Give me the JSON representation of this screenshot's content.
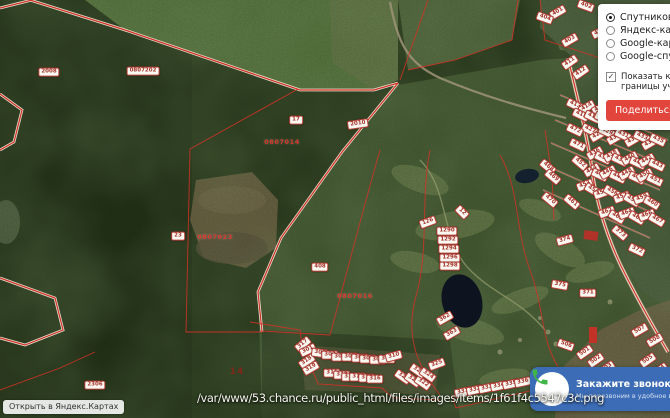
{
  "panel": {
    "options": [
      {
        "label": "Спутниковая карта",
        "selected": true
      },
      {
        "label": "Яндекс-карта",
        "selected": false
      },
      {
        "label": "Google-карта",
        "selected": false
      },
      {
        "label": "Google-спутник",
        "selected": false
      }
    ],
    "checkbox": {
      "label": "Показать кадастровые границы участков",
      "checked": true
    },
    "share_button": {
      "label": "Поделиться",
      "bg": "#e2453c",
      "color": "#ffffff"
    }
  },
  "call_widget": {
    "title": "Закажите звонок",
    "subtitle": "Мы перезвоним в удобное время",
    "bg": "#3c6cb5",
    "phone_icon_color": "#3fb549"
  },
  "yandex_button": {
    "label": "Открыть в Яндекс.Картах"
  },
  "overlay_path": "/var/www/53.chance.ru/public_html/files/images/items/1f61f4c5547c3c.png",
  "map": {
    "boundary_color": "#d23227",
    "labels": [
      {
        "x": 49,
        "y": 72,
        "r": 0,
        "t": "2008",
        "k": "box"
      },
      {
        "x": 143,
        "y": 71,
        "r": 0,
        "t": "0807202",
        "k": "box"
      },
      {
        "x": 296,
        "y": 120,
        "r": 0,
        "t": "17",
        "k": "box"
      },
      {
        "x": 358,
        "y": 124,
        "r": -8,
        "t": "2010",
        "k": "box"
      },
      {
        "x": 178,
        "y": 236,
        "r": 0,
        "t": "23",
        "k": "box"
      },
      {
        "x": 95,
        "y": 385,
        "r": 0,
        "t": "2306",
        "k": "box"
      },
      {
        "x": 282,
        "y": 142,
        "r": 0,
        "t": "0807014",
        "k": "red"
      },
      {
        "x": 215,
        "y": 237,
        "r": 0,
        "t": "0807023",
        "k": "red"
      },
      {
        "x": 355,
        "y": 296,
        "r": 0,
        "t": "0807016",
        "k": "red"
      },
      {
        "x": 237,
        "y": 372,
        "r": 0,
        "t": "14",
        "k": "qn"
      },
      {
        "x": 428,
        "y": 222,
        "r": -20,
        "t": "126",
        "k": "box"
      },
      {
        "x": 447,
        "y": 231,
        "r": 0,
        "t": "1290",
        "k": "box"
      },
      {
        "x": 448,
        "y": 240,
        "r": 0,
        "t": "1292",
        "k": "box"
      },
      {
        "x": 449,
        "y": 249,
        "r": 0,
        "t": "1294",
        "k": "box"
      },
      {
        "x": 450,
        "y": 258,
        "r": 0,
        "t": "1296",
        "k": "box"
      },
      {
        "x": 450,
        "y": 266,
        "r": 0,
        "t": "1298",
        "k": "box"
      },
      {
        "x": 320,
        "y": 267,
        "r": 0,
        "t": "408",
        "k": "box"
      },
      {
        "x": 462,
        "y": 212,
        "r": 45,
        "t": "12",
        "k": "box"
      },
      {
        "x": 558,
        "y": 12,
        "r": -30,
        "t": "401",
        "k": "box"
      },
      {
        "x": 586,
        "y": 6,
        "r": 20,
        "t": "402",
        "k": "box"
      },
      {
        "x": 570,
        "y": 40,
        "r": -30,
        "t": "403",
        "k": "box"
      },
      {
        "x": 545,
        "y": 18,
        "r": 20,
        "t": "404",
        "k": "box"
      },
      {
        "x": 600,
        "y": 32,
        "r": -25,
        "t": "405",
        "k": "box"
      },
      {
        "x": 570,
        "y": 62,
        "r": -35,
        "t": "411",
        "k": "box"
      },
      {
        "x": 581,
        "y": 72,
        "r": -35,
        "t": "412",
        "k": "box"
      },
      {
        "x": 575,
        "y": 105,
        "r": 25,
        "t": "413",
        "k": "box"
      },
      {
        "x": 587,
        "y": 107,
        "r": -30,
        "t": "414",
        "k": "box"
      },
      {
        "x": 581,
        "y": 115,
        "r": 25,
        "t": "415",
        "k": "box"
      },
      {
        "x": 600,
        "y": 108,
        "r": -30,
        "t": "416",
        "k": "box"
      },
      {
        "x": 593,
        "y": 117,
        "r": 25,
        "t": "417",
        "k": "box"
      },
      {
        "x": 612,
        "y": 103,
        "r": -30,
        "t": "418",
        "k": "box"
      },
      {
        "x": 603,
        "y": 118,
        "r": 25,
        "t": "419",
        "k": "box"
      },
      {
        "x": 618,
        "y": 113,
        "r": -30,
        "t": "420",
        "k": "box"
      },
      {
        "x": 625,
        "y": 105,
        "r": 25,
        "t": "421",
        "k": "box"
      },
      {
        "x": 630,
        "y": 115,
        "r": -30,
        "t": "422",
        "k": "box"
      },
      {
        "x": 640,
        "y": 110,
        "r": 25,
        "t": "423",
        "k": "box"
      },
      {
        "x": 647,
        "y": 120,
        "r": -30,
        "t": "424",
        "k": "box"
      },
      {
        "x": 655,
        "y": 112,
        "r": 25,
        "t": "425",
        "k": "box"
      },
      {
        "x": 660,
        "y": 122,
        "r": -30,
        "t": "426",
        "k": "box"
      },
      {
        "x": 590,
        "y": 130,
        "r": 25,
        "t": "427",
        "k": "box"
      },
      {
        "x": 598,
        "y": 135,
        "r": -30,
        "t": "428",
        "k": "box"
      },
      {
        "x": 607,
        "y": 132,
        "r": 25,
        "t": "429",
        "k": "box"
      },
      {
        "x": 615,
        "y": 138,
        "r": -30,
        "t": "430",
        "k": "box"
      },
      {
        "x": 623,
        "y": 135,
        "r": 25,
        "t": "431",
        "k": "box"
      },
      {
        "x": 633,
        "y": 140,
        "r": -30,
        "t": "432",
        "k": "box"
      },
      {
        "x": 642,
        "y": 137,
        "r": 25,
        "t": "433",
        "k": "box"
      },
      {
        "x": 650,
        "y": 143,
        "r": -30,
        "t": "434",
        "k": "box"
      },
      {
        "x": 658,
        "y": 140,
        "r": 25,
        "t": "435",
        "k": "box"
      },
      {
        "x": 595,
        "y": 153,
        "r": -30,
        "t": "436",
        "k": "box"
      },
      {
        "x": 603,
        "y": 158,
        "r": 25,
        "t": "437",
        "k": "box"
      },
      {
        "x": 612,
        "y": 155,
        "r": -30,
        "t": "438",
        "k": "box"
      },
      {
        "x": 620,
        "y": 160,
        "r": 25,
        "t": "439",
        "k": "box"
      },
      {
        "x": 630,
        "y": 158,
        "r": -30,
        "t": "440",
        "k": "box"
      },
      {
        "x": 638,
        "y": 163,
        "r": 25,
        "t": "441",
        "k": "box"
      },
      {
        "x": 647,
        "y": 160,
        "r": -30,
        "t": "442",
        "k": "box"
      },
      {
        "x": 657,
        "y": 165,
        "r": 25,
        "t": "443",
        "k": "box"
      },
      {
        "x": 592,
        "y": 170,
        "r": -30,
        "t": "444",
        "k": "box"
      },
      {
        "x": 600,
        "y": 175,
        "r": 25,
        "t": "445",
        "k": "box"
      },
      {
        "x": 608,
        "y": 172,
        "r": -30,
        "t": "446",
        "k": "box"
      },
      {
        "x": 618,
        "y": 177,
        "r": 25,
        "t": "447",
        "k": "box"
      },
      {
        "x": 627,
        "y": 173,
        "r": -30,
        "t": "448",
        "k": "box"
      },
      {
        "x": 637,
        "y": 178,
        "r": 25,
        "t": "449",
        "k": "box"
      },
      {
        "x": 645,
        "y": 175,
        "r": -30,
        "t": "450",
        "k": "box"
      },
      {
        "x": 655,
        "y": 180,
        "r": 25,
        "t": "451",
        "k": "box"
      },
      {
        "x": 580,
        "y": 163,
        "r": 40,
        "t": "452",
        "k": "box"
      },
      {
        "x": 585,
        "y": 185,
        "r": -20,
        "t": "453",
        "k": "box"
      },
      {
        "x": 593,
        "y": 190,
        "r": 30,
        "t": "454",
        "k": "box"
      },
      {
        "x": 602,
        "y": 193,
        "r": -20,
        "t": "455",
        "k": "box"
      },
      {
        "x": 612,
        "y": 192,
        "r": 30,
        "t": "456",
        "k": "box"
      },
      {
        "x": 622,
        "y": 197,
        "r": -20,
        "t": "457",
        "k": "box"
      },
      {
        "x": 632,
        "y": 200,
        "r": 30,
        "t": "458",
        "k": "box"
      },
      {
        "x": 642,
        "y": 198,
        "r": -20,
        "t": "459",
        "k": "box"
      },
      {
        "x": 652,
        "y": 203,
        "r": 30,
        "t": "460",
        "k": "box"
      },
      {
        "x": 572,
        "y": 202,
        "r": 40,
        "t": "461",
        "k": "box"
      },
      {
        "x": 607,
        "y": 212,
        "r": -20,
        "t": "462",
        "k": "box"
      },
      {
        "x": 617,
        "y": 217,
        "r": 30,
        "t": "463",
        "k": "box"
      },
      {
        "x": 627,
        "y": 213,
        "r": -20,
        "t": "464",
        "k": "box"
      },
      {
        "x": 637,
        "y": 218,
        "r": 30,
        "t": "465",
        "k": "box"
      },
      {
        "x": 647,
        "y": 215,
        "r": -20,
        "t": "466",
        "k": "box"
      },
      {
        "x": 657,
        "y": 220,
        "r": 30,
        "t": "467",
        "k": "box"
      },
      {
        "x": 548,
        "y": 167,
        "r": 40,
        "t": "468",
        "k": "box"
      },
      {
        "x": 553,
        "y": 177,
        "r": 40,
        "t": "469",
        "k": "box"
      },
      {
        "x": 550,
        "y": 200,
        "r": 40,
        "t": "470",
        "k": "box"
      },
      {
        "x": 578,
        "y": 145,
        "r": 25,
        "t": "471",
        "k": "box"
      },
      {
        "x": 575,
        "y": 130,
        "r": 25,
        "t": "472",
        "k": "box"
      },
      {
        "x": 303,
        "y": 344,
        "r": -40,
        "t": "317",
        "k": "box"
      },
      {
        "x": 307,
        "y": 361,
        "r": -35,
        "t": "318",
        "k": "box"
      },
      {
        "x": 311,
        "y": 368,
        "r": -30,
        "t": "319",
        "k": "box"
      },
      {
        "x": 308,
        "y": 350,
        "r": -25,
        "t": "301",
        "k": "box"
      },
      {
        "x": 320,
        "y": 353,
        "r": 8,
        "t": "302",
        "k": "box"
      },
      {
        "x": 330,
        "y": 355,
        "r": 0,
        "t": "303",
        "k": "box"
      },
      {
        "x": 340,
        "y": 357,
        "r": 0,
        "t": "304",
        "k": "box"
      },
      {
        "x": 350,
        "y": 357,
        "r": 0,
        "t": "305",
        "k": "box"
      },
      {
        "x": 360,
        "y": 358,
        "r": 0,
        "t": "306",
        "k": "box"
      },
      {
        "x": 368,
        "y": 359,
        "r": 0,
        "t": "307",
        "k": "box"
      },
      {
        "x": 378,
        "y": 360,
        "r": 0,
        "t": "308",
        "k": "box"
      },
      {
        "x": 387,
        "y": 359,
        "r": 0,
        "t": "309",
        "k": "box"
      },
      {
        "x": 394,
        "y": 356,
        "r": -15,
        "t": "310",
        "k": "box"
      },
      {
        "x": 332,
        "y": 373,
        "r": 0,
        "t": "311",
        "k": "box"
      },
      {
        "x": 342,
        "y": 375,
        "r": 0,
        "t": "312",
        "k": "box"
      },
      {
        "x": 350,
        "y": 377,
        "r": 0,
        "t": "313",
        "k": "box"
      },
      {
        "x": 358,
        "y": 377,
        "r": 0,
        "t": "314",
        "k": "box"
      },
      {
        "x": 367,
        "y": 378,
        "r": 0,
        "t": "315",
        "k": "box"
      },
      {
        "x": 375,
        "y": 379,
        "r": 0,
        "t": "316",
        "k": "box"
      },
      {
        "x": 403,
        "y": 377,
        "r": 35,
        "t": "320",
        "k": "box"
      },
      {
        "x": 413,
        "y": 380,
        "r": 35,
        "t": "321",
        "k": "box"
      },
      {
        "x": 423,
        "y": 383,
        "r": 35,
        "t": "322",
        "k": "box"
      },
      {
        "x": 418,
        "y": 371,
        "r": 35,
        "t": "323",
        "k": "box"
      },
      {
        "x": 428,
        "y": 375,
        "r": 35,
        "t": "324",
        "k": "box"
      },
      {
        "x": 437,
        "y": 364,
        "r": -20,
        "t": "325",
        "k": "box"
      },
      {
        "x": 463,
        "y": 392,
        "r": -12,
        "t": "331",
        "k": "box"
      },
      {
        "x": 475,
        "y": 390,
        "r": -12,
        "t": "332",
        "k": "box"
      },
      {
        "x": 487,
        "y": 388,
        "r": -12,
        "t": "333",
        "k": "box"
      },
      {
        "x": 499,
        "y": 386,
        "r": -12,
        "t": "334",
        "k": "box"
      },
      {
        "x": 511,
        "y": 384,
        "r": -12,
        "t": "335",
        "k": "box"
      },
      {
        "x": 523,
        "y": 382,
        "r": -12,
        "t": "336",
        "k": "box"
      },
      {
        "x": 588,
        "y": 293,
        "r": 0,
        "t": "371",
        "k": "box"
      },
      {
        "x": 637,
        "y": 250,
        "r": 25,
        "t": "372",
        "k": "box"
      },
      {
        "x": 620,
        "y": 233,
        "r": 40,
        "t": "373",
        "k": "box"
      },
      {
        "x": 565,
        "y": 240,
        "r": -15,
        "t": "374",
        "k": "box"
      },
      {
        "x": 560,
        "y": 285,
        "r": 10,
        "t": "375",
        "k": "box"
      },
      {
        "x": 445,
        "y": 318,
        "r": -30,
        "t": "362",
        "k": "box"
      },
      {
        "x": 452,
        "y": 333,
        "r": -30,
        "t": "363",
        "k": "box"
      },
      {
        "x": 585,
        "y": 352,
        "r": -35,
        "t": "501",
        "k": "box"
      },
      {
        "x": 596,
        "y": 360,
        "r": -35,
        "t": "502",
        "k": "box"
      },
      {
        "x": 607,
        "y": 368,
        "r": -35,
        "t": "503",
        "k": "box"
      },
      {
        "x": 660,
        "y": 370,
        "r": -35,
        "t": "504",
        "k": "box"
      },
      {
        "x": 648,
        "y": 360,
        "r": -35,
        "t": "505",
        "k": "box"
      },
      {
        "x": 566,
        "y": 345,
        "r": 20,
        "t": "506",
        "k": "box"
      },
      {
        "x": 640,
        "y": 330,
        "r": -30,
        "t": "507",
        "k": "box"
      },
      {
        "x": 655,
        "y": 340,
        "r": -30,
        "t": "508",
        "k": "box"
      }
    ]
  }
}
